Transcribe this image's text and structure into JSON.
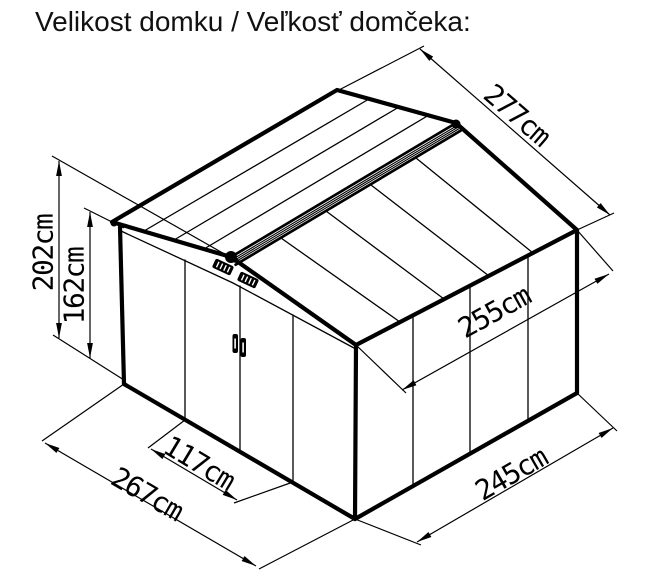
{
  "title": "Velikost domku / Veľkosť domčeka:",
  "diagram": {
    "type": "isometric-garden-shed-dimension-drawing",
    "unit": "cm",
    "dimensions": {
      "total_height": "202cm",
      "wall_height": "162cm",
      "roof_width": "277cm",
      "roof_depth": "255cm",
      "base_depth": "245cm",
      "base_width": "267cm",
      "door_width": "117cm"
    },
    "colors": {
      "line": "#000000",
      "background": "#ffffff",
      "text": "#111111"
    }
  }
}
